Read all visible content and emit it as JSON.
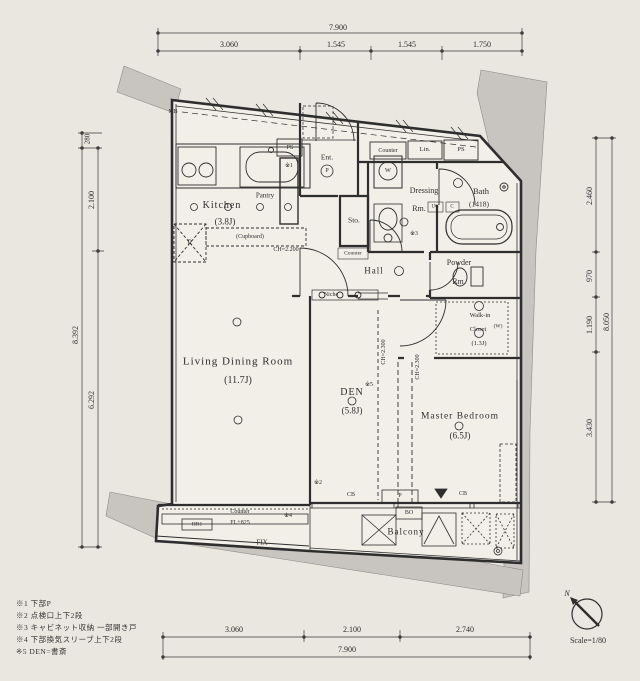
{
  "dims": {
    "top_total": "7.900",
    "top1": "3.060",
    "top2": "1.545",
    "top3": "1.545",
    "top4": "1.750",
    "bottom1": "3.060",
    "bottom2": "2.100",
    "bottom3": "2.740",
    "bottom_total": "7.900",
    "left_total": "8.392",
    "left_offset": "280",
    "left1": "2.100",
    "left2": "6.292",
    "right1": "2.460",
    "right2": "970",
    "right3": "1.190",
    "right4": "3.430",
    "right_total": "8.050"
  },
  "rooms": {
    "kitchen": {
      "name": "Kitchen",
      "size": "(3.8J)"
    },
    "living_dining": {
      "name": "Living Dining Room",
      "size": "(11.7J)"
    },
    "den": {
      "name": "DEN",
      "size": "(5.8J)",
      "note": "※5"
    },
    "master_bedroom": {
      "name": "Master Bedroom",
      "size": "(6.5J)"
    },
    "bath": {
      "name": "Bath",
      "size": "(1418)"
    },
    "dressing_room": {
      "name": "Dressing",
      "suffix": "Rm."
    },
    "powder_room": {
      "name": "Powder",
      "suffix": "Rm."
    },
    "walk_in_closet": {
      "line1": "Walk-in",
      "line2": "Closet",
      "size": "(1.3J)",
      "side": "(W)"
    },
    "hall": {
      "name": "Hall"
    },
    "entrance": {
      "name": "Ent.",
      "porch": "P"
    },
    "storage": {
      "name": "Sto."
    },
    "balcony": {
      "name": "Balcony"
    }
  },
  "labels": {
    "mb": "MB",
    "ps_left": "PS",
    "ps_right": "PS",
    "counter_top": "Counter",
    "linen": "Lin.",
    "washer": "W",
    "pantry": "Pantry",
    "cupboard": "(Cupboard)",
    "fridge": "R",
    "ch_kitchen": "CH=2.200",
    "ch_den": "CH=2.300",
    "ch_master": "CH=2.300",
    "niche": "Niche",
    "counter_hall": "Counter",
    "uc": "UC",
    "c": "C",
    "counter_bottom": "Counter",
    "floor_level": "FL+825",
    "fix": "FIX",
    "hr": "HR1",
    "cb_left": "CB",
    "cb_right": "CB",
    "p_box": "P",
    "bo": "BO",
    "ref1": "※1",
    "ref2": "※2",
    "ref3": "※3",
    "ref4": "※4",
    "ref5": "※5"
  },
  "notes": {
    "n1": "※1 下部P",
    "n2": "※2 点検口上下2段",
    "n3": "※3 キャビネット収納 一部開き戸",
    "n4": "※4 下部換気スリーブ上下2段",
    "n5": "※5 DEN=書斎"
  },
  "footer": {
    "scale": "Scale=1/80",
    "north": "N"
  }
}
